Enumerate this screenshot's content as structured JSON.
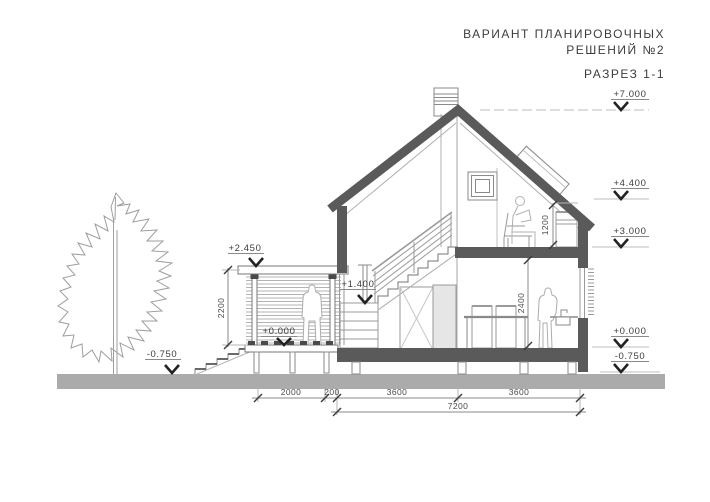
{
  "header": {
    "title_line1": "ВАРИАНТ ПЛАНИРОВОЧНЫХ",
    "title_line2": "РЕШЕНИЙ №2",
    "view_label": "РАЗРЕЗ 1-1"
  },
  "levels": {
    "p7000": "+7.000",
    "p4400": "+4.400",
    "p3000": "+3.000",
    "p2450": "+2.450",
    "p1400": "+1.400",
    "p0000": "+0.000",
    "n0750": "-0.750"
  },
  "dimensions": {
    "terrace_width": "2000",
    "wall_gap": "200",
    "bay": "3600",
    "total_width": "7200",
    "terrace_height": "2200",
    "knee_wall_height": "1200",
    "room_height": "2400"
  },
  "colors": {
    "section": "#5a5a5a",
    "ground": "#ababab",
    "thin_line": "#8a8a8a",
    "text": "#3d3d3d"
  }
}
